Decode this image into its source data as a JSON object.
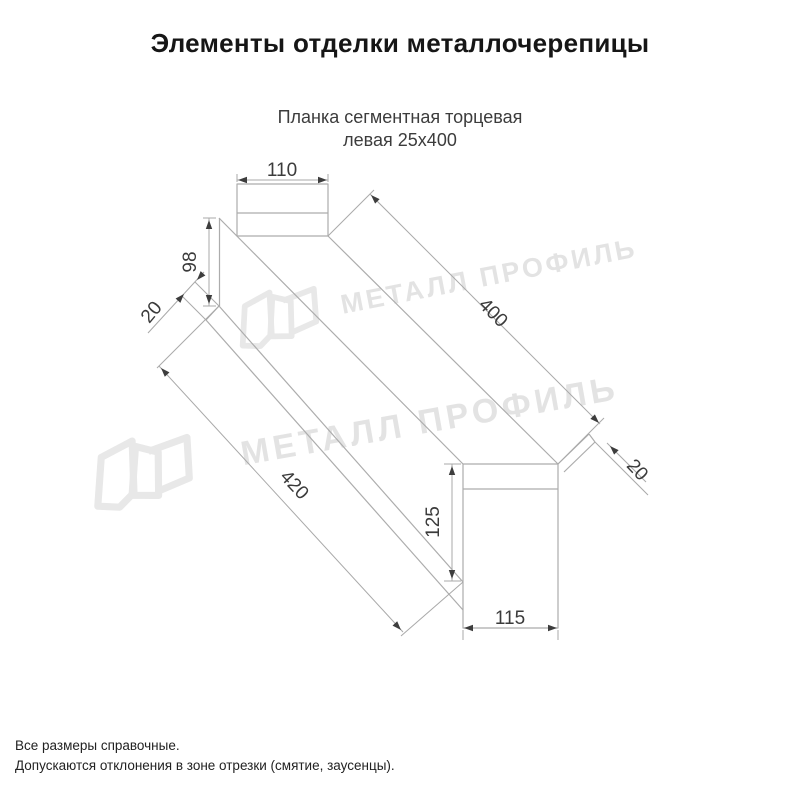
{
  "title": "Элементы отделки металлочерепицы",
  "subtitle": {
    "line1": "Планка сегментная торцевая",
    "line2": "левая 25х400"
  },
  "drawing": {
    "dims": {
      "tab_width": "110",
      "left_height": "98",
      "left_fold": "20",
      "top_length": "400",
      "right_fold": "20",
      "bottom_length": "420",
      "end_height": "125",
      "end_width": "115"
    }
  },
  "watermark": {
    "text": "МЕТАЛЛ ПРОФИЛЬ"
  },
  "notes": {
    "line1": "Все размеры справочные.",
    "line2": "Допускаются отклонения в зоне отрезки (смятие, заусенцы)."
  }
}
